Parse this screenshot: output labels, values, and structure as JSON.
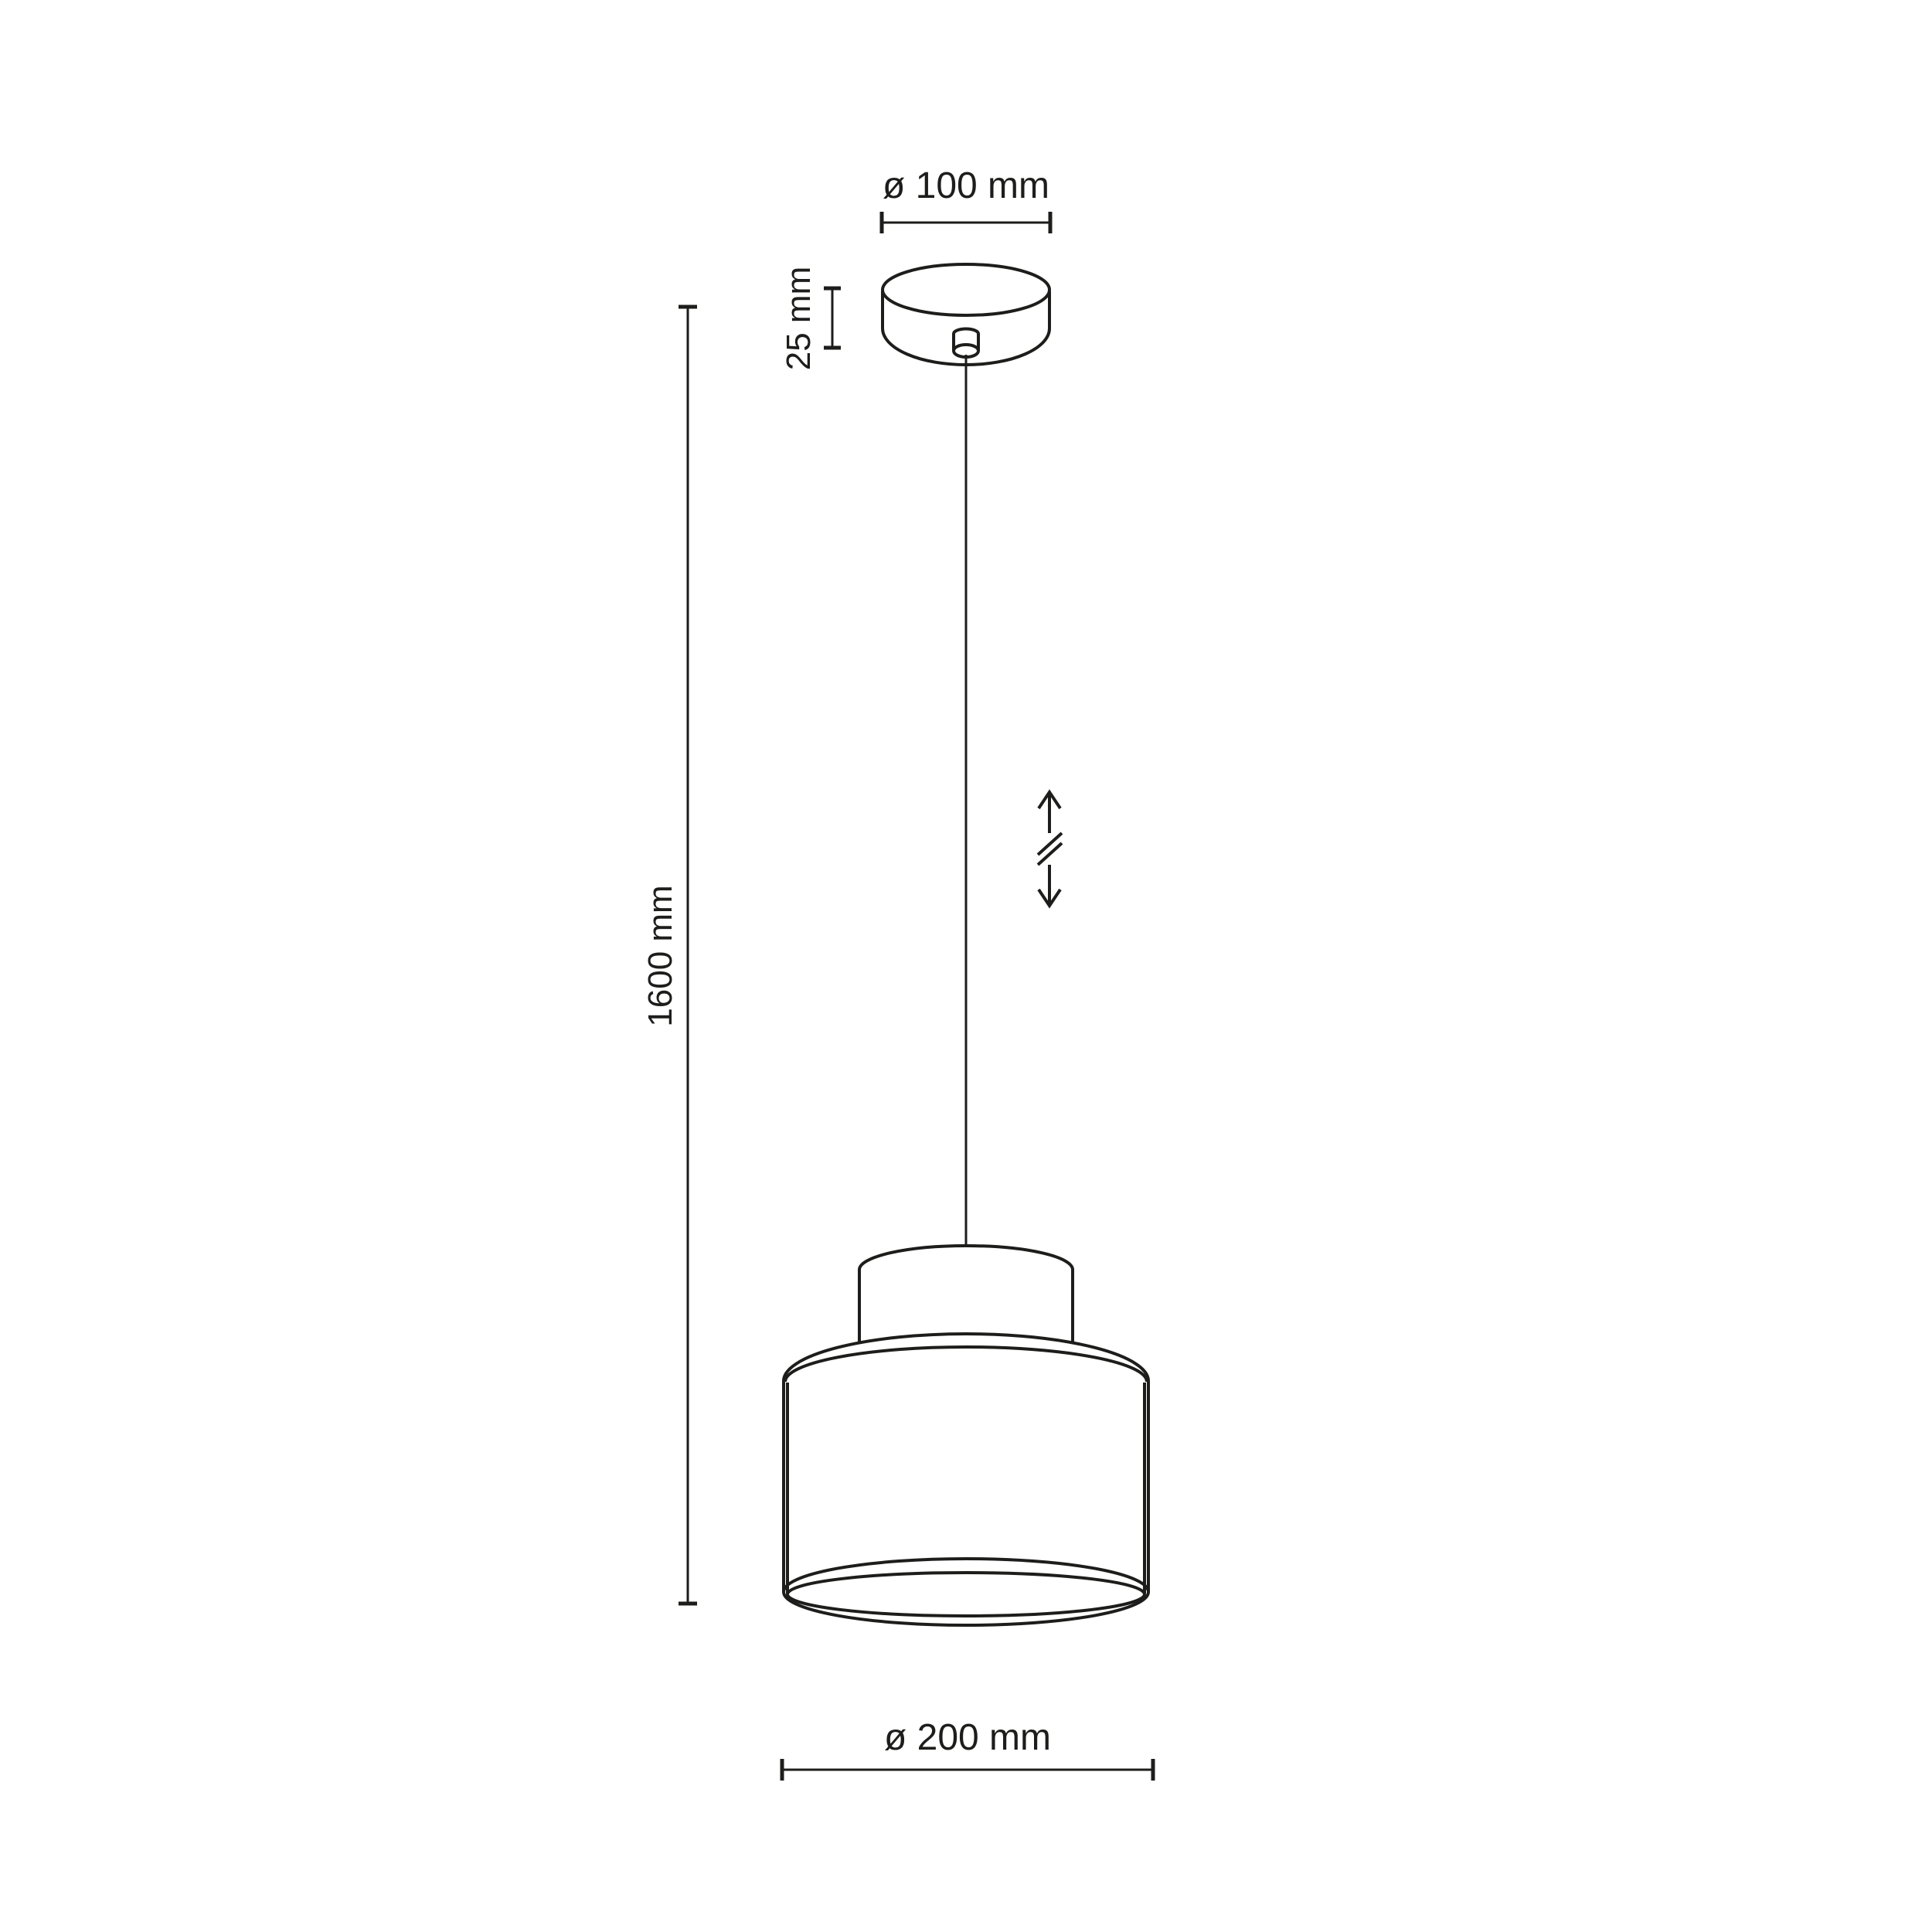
{
  "colors": {
    "background": "#ffffff",
    "line": "#1d1d1b"
  },
  "labels": {
    "canopy_diameter": "ø 100 mm",
    "canopy_height": "25 mm",
    "suspension_length": "1600 mm",
    "shade_diameter": "ø 200 mm"
  },
  "icons": {
    "height_adjust": "height-adjustable-double-arrow-icon"
  }
}
